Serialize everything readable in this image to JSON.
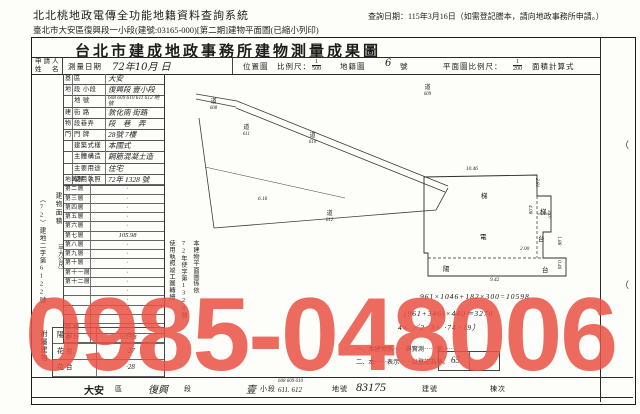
{
  "watermark": {
    "text": "0985-048006",
    "color": "rgba(234,80,67,0.85)"
  },
  "header": {
    "system_title": "北北桃地政電傳全功能地籍資料查詢系統",
    "subtitle": "臺北市大安區復興段一小段(建號:03165-000)[第二期]建物平面圖(已縮小列印)",
    "query_date": "查詢日期：115年3月16日（如需登記謄本，請向地政事務所申請。）"
  },
  "doc": {
    "title": "台北市建成地政事務所建物測量成果圖",
    "applicant_label_1": "申請人",
    "applicant_label_2": "姓　名",
    "survey_date_label": "測量日期",
    "survey_date_value": "72年10月 日",
    "location_map_label": "位置圖",
    "scale_label": "比例尺：",
    "location_scale_num": "1",
    "location_scale_den": "500",
    "cadastral_label": "地籍圖",
    "cadastral_no": "6",
    "cadastral_no_unit": "號",
    "plan_scale_label": "平面圖比例尺：",
    "plan_scale_num": "1",
    "plan_scale_den": "200",
    "calc_label": "面積計算式"
  },
  "form_rows": [
    {
      "group": "基",
      "label": "區",
      "value": "大安"
    },
    {
      "group": "地",
      "label": "段 小段",
      "value": "復興段 壹小段"
    },
    {
      "group": "",
      "label": "地 號",
      "value": "608 609 610 611 612 地號"
    },
    {
      "group": "建",
      "label": "街 路",
      "value": "敦化南 街路"
    },
    {
      "group": "物",
      "label": "段巷弄",
      "value": "段　巷　弄"
    },
    {
      "group": "門",
      "label": "門 牌",
      "value": "28號 7樓"
    },
    {
      "group": "",
      "label": "建築式樣",
      "value": "本國式"
    },
    {
      "group": "",
      "label": "主體構造",
      "value": "鋼筋混凝土造"
    },
    {
      "group": "",
      "label": "主要用途",
      "value": "住宅"
    },
    {
      "group": "",
      "label": "使用執照",
      "value": "72年 1328 號"
    }
  ],
  "floor_table": {
    "side_label": "建物面積",
    "side_label_unit": "（平方公尺）",
    "rows": [
      {
        "name": "地面層",
        "value": "·"
      },
      {
        "name": "第二層",
        "value": "·"
      },
      {
        "name": "第三層",
        "value": "·"
      },
      {
        "name": "第四層",
        "value": "·"
      },
      {
        "name": "第五層",
        "value": "·"
      },
      {
        "name": "第六層",
        "value": "·"
      },
      {
        "name": "第七層",
        "value": "105.98"
      },
      {
        "name": "第八層",
        "value": "·"
      },
      {
        "name": "第九層",
        "value": "·"
      },
      {
        "name": "第十層",
        "value": "·"
      },
      {
        "name": "第十一層",
        "value": "·"
      },
      {
        "name": "第十二層",
        "value": "·"
      },
      {
        "name": "",
        "value": "·"
      },
      {
        "name": "",
        "value": "·"
      },
      {
        "name": "",
        "value": "·"
      },
      {
        "name": "",
        "value": "·"
      },
      {
        "name": "騎 樓",
        "value": "·"
      },
      {
        "name": "合 計",
        "value": "105.98"
      }
    ]
  },
  "margin": {
    "file_no": "（72）建地二字第6122號",
    "annex_label": "附屬建物"
  },
  "annex_rows": [
    {
      "use": "陽台",
      "value": "·91"
    },
    {
      "use": "花台",
      "value": "·27"
    },
    {
      "use": "花台",
      "value": "·28"
    }
  ],
  "side_note_cols": [
    "本建物平面圖係依",
    "72年使字第1328號",
    "使用執照竣工圖轉繪"
  ],
  "notes": [
    "一、本建物係⋯⋯與實測⋯⋯量⋯⋯",
    "二、本⋯⋯表示⋯⋯以登記為準。"
  ],
  "calc_lines": [
    "961×1046+182×300=10598",
    "(961+346)×440＝3270",
    "4× ／2· 3× ·74 ·（9）"
  ],
  "stamp_box_value": "65",
  "location_map": {
    "labels": [
      {
        "c": "道",
        "n": "608",
        "x": 210,
        "y": 100
      },
      {
        "c": "道",
        "n": "609",
        "x": 424,
        "y": 86
      },
      {
        "c": "道",
        "n": "611",
        "x": 243,
        "y": 126
      },
      {
        "c": "道",
        "n": "610",
        "x": 309,
        "y": 134
      },
      {
        "c": "道",
        "n": "612",
        "x": 326,
        "y": 212
      }
    ],
    "dims": [
      {
        "t": "6.16",
        "x": 258,
        "y": 196
      }
    ]
  },
  "floor_plan": {
    "dims": [
      {
        "t": "10.46",
        "x": 466,
        "y": 166,
        "r": 0
      },
      {
        "t": "9.42",
        "x": 490,
        "y": 277,
        "r": 0
      },
      {
        "t": "2.81",
        "x": 540,
        "y": 178,
        "r": 1
      },
      {
        "t": "4.08",
        "x": 533,
        "y": 205,
        "r": 1
      },
      {
        "t": "3.07",
        "x": 552,
        "y": 210,
        "r": 1
      },
      {
        "t": "2.00",
        "x": 520,
        "y": 246,
        "r": 0
      },
      {
        "t": "1.88",
        "x": 562,
        "y": 236,
        "r": 1
      },
      {
        "t": "0.46",
        "x": 562,
        "y": 260,
        "r": 1
      }
    ],
    "glyphs": [
      {
        "t": "梯",
        "x": 481,
        "y": 190
      },
      {
        "t": "電",
        "x": 480,
        "y": 231
      },
      {
        "t": "陽",
        "x": 443,
        "y": 263
      },
      {
        "t": "梯",
        "x": 540,
        "y": 206
      },
      {
        "t": "台",
        "x": 538,
        "y": 233
      },
      {
        "t": "台",
        "x": 542,
        "y": 264
      }
    ]
  },
  "footer": {
    "district_value": "大安",
    "district_label": "區",
    "section_value": "復興",
    "section_label": "段",
    "subsection_value": "壹",
    "subsection_label": "小段",
    "parcels_line1": "608 609 610",
    "parcels_line2": "611. 612",
    "parcel_label": "地號",
    "building_no": "83175",
    "building_label": "建號",
    "unit_label": "棟次"
  },
  "fold_marks": [
    "（",
    "（"
  ]
}
